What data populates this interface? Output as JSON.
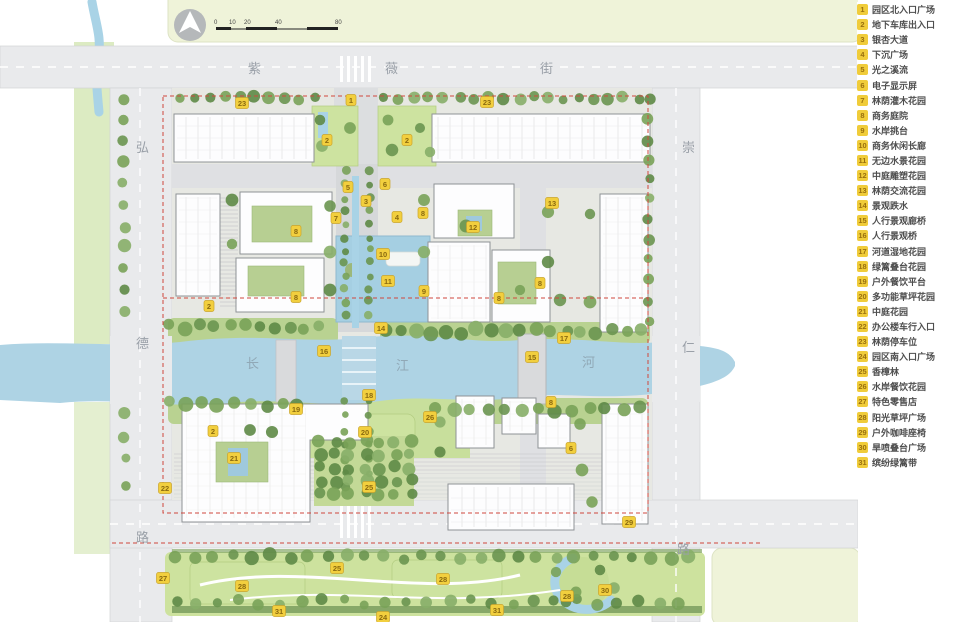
{
  "legend": {
    "items": [
      {
        "num": "1",
        "label": "园区北入口广场"
      },
      {
        "num": "2",
        "label": "地下车库出入口"
      },
      {
        "num": "3",
        "label": "银杏大道"
      },
      {
        "num": "4",
        "label": "下沉广场"
      },
      {
        "num": "5",
        "label": "光之溪流"
      },
      {
        "num": "6",
        "label": "电子显示屏"
      },
      {
        "num": "7",
        "label": "林荫灌木花园"
      },
      {
        "num": "8",
        "label": "商务庭院"
      },
      {
        "num": "9",
        "label": "水岸挑台"
      },
      {
        "num": "10",
        "label": "商务休闲长廊"
      },
      {
        "num": "11",
        "label": "无边水景花园"
      },
      {
        "num": "12",
        "label": "中庭雕塑花园"
      },
      {
        "num": "13",
        "label": "林荫交流花园"
      },
      {
        "num": "14",
        "label": "景观跌水"
      },
      {
        "num": "15",
        "label": "人行景观廊桥"
      },
      {
        "num": "16",
        "label": "人行景观桥"
      },
      {
        "num": "17",
        "label": "河道湿地花园"
      },
      {
        "num": "18",
        "label": "绿篱叠台花园"
      },
      {
        "num": "19",
        "label": "户外餐饮平台"
      },
      {
        "num": "20",
        "label": "多功能草坪花园"
      },
      {
        "num": "21",
        "label": "中庭花园"
      },
      {
        "num": "22",
        "label": "办公楼车行入口"
      },
      {
        "num": "23",
        "label": "林荫停车位"
      },
      {
        "num": "24",
        "label": "园区南入口广场"
      },
      {
        "num": "25",
        "label": "香樟林"
      },
      {
        "num": "26",
        "label": "水岸餐饮花园"
      },
      {
        "num": "27",
        "label": "特色零售店"
      },
      {
        "num": "28",
        "label": "阳光草坪广场"
      },
      {
        "num": "29",
        "label": "户外咖啡座椅"
      },
      {
        "num": "30",
        "label": "旱喷叠台广场"
      },
      {
        "num": "31",
        "label": "缤纷绿篱带"
      }
    ]
  },
  "map": {
    "streets": {
      "top": "紫薇街",
      "left": "弘德路",
      "right": "崇仁路",
      "river": "长江河"
    },
    "scale": {
      "ticks": [
        "0",
        "10",
        "20",
        "40",
        "80"
      ]
    },
    "icons": {
      "north_arrow": "north-arrow-icon"
    },
    "markers": [
      {
        "n": "1",
        "x": 351,
        "y": 100
      },
      {
        "n": "23",
        "x": 242,
        "y": 103
      },
      {
        "n": "23",
        "x": 487,
        "y": 102
      },
      {
        "n": "2",
        "x": 327,
        "y": 140
      },
      {
        "n": "2",
        "x": 407,
        "y": 140
      },
      {
        "n": "6",
        "x": 385,
        "y": 184
      },
      {
        "n": "5",
        "x": 348,
        "y": 187
      },
      {
        "n": "3",
        "x": 366,
        "y": 201
      },
      {
        "n": "13",
        "x": 552,
        "y": 203
      },
      {
        "n": "8",
        "x": 423,
        "y": 213
      },
      {
        "n": "4",
        "x": 397,
        "y": 217
      },
      {
        "n": "7",
        "x": 336,
        "y": 218
      },
      {
        "n": "12",
        "x": 473,
        "y": 227
      },
      {
        "n": "8",
        "x": 296,
        "y": 231
      },
      {
        "n": "10",
        "x": 383,
        "y": 254
      },
      {
        "n": "11",
        "x": 388,
        "y": 281
      },
      {
        "n": "8",
        "x": 540,
        "y": 283
      },
      {
        "n": "9",
        "x": 424,
        "y": 291
      },
      {
        "n": "8",
        "x": 296,
        "y": 297
      },
      {
        "n": "8",
        "x": 499,
        "y": 298
      },
      {
        "n": "2",
        "x": 209,
        "y": 306
      },
      {
        "n": "14",
        "x": 381,
        "y": 328
      },
      {
        "n": "17",
        "x": 564,
        "y": 338
      },
      {
        "n": "16",
        "x": 324,
        "y": 351
      },
      {
        "n": "15",
        "x": 532,
        "y": 357
      },
      {
        "n": "18",
        "x": 369,
        "y": 395
      },
      {
        "n": "19",
        "x": 296,
        "y": 409
      },
      {
        "n": "8",
        "x": 551,
        "y": 402
      },
      {
        "n": "26",
        "x": 430,
        "y": 417
      },
      {
        "n": "2",
        "x": 213,
        "y": 431
      },
      {
        "n": "20",
        "x": 365,
        "y": 432
      },
      {
        "n": "6",
        "x": 571,
        "y": 448
      },
      {
        "n": "21",
        "x": 234,
        "y": 458
      },
      {
        "n": "25",
        "x": 369,
        "y": 487
      },
      {
        "n": "22",
        "x": 165,
        "y": 488
      },
      {
        "n": "29",
        "x": 629,
        "y": 522
      },
      {
        "n": "25",
        "x": 337,
        "y": 568
      },
      {
        "n": "27",
        "x": 163,
        "y": 578
      },
      {
        "n": "28",
        "x": 242,
        "y": 586
      },
      {
        "n": "28",
        "x": 443,
        "y": 579
      },
      {
        "n": "30",
        "x": 605,
        "y": 590
      },
      {
        "n": "28",
        "x": 567,
        "y": 596
      },
      {
        "n": "31",
        "x": 279,
        "y": 611
      },
      {
        "n": "31",
        "x": 497,
        "y": 610
      },
      {
        "n": "24",
        "x": 383,
        "y": 617
      }
    ]
  },
  "colors": {
    "marker_bg": "#f2cf3e",
    "marker_text": "#8a6a10",
    "river": "#aed3e4",
    "road": "#e9eaec",
    "offsite": "#eff3d9",
    "red_line": "#d0473d"
  }
}
